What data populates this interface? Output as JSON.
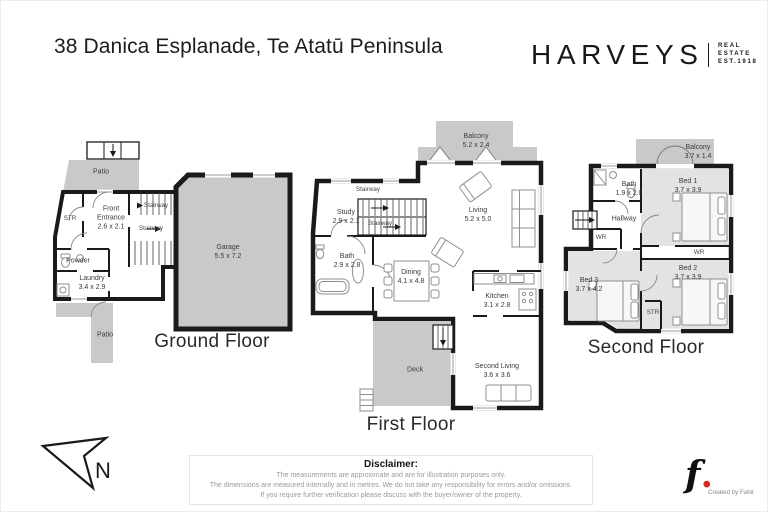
{
  "title": "38 Danica Esplanade, Te Atatū Peninsula",
  "brand": {
    "name": "HARVEYS",
    "tagline": [
      "REAL",
      "ESTATE",
      "EST.1918"
    ]
  },
  "colors": {
    "wall": "#1a1a1a",
    "outdoor_area": "#c9c9c9",
    "carpet": "#e3e3e3",
    "accent_red": "#d42b1e"
  },
  "floors": {
    "ground": {
      "name": "Ground Floor",
      "rooms": {
        "patio_top": {
          "label": "Patio"
        },
        "str": {
          "label": "STR"
        },
        "front_entrance": {
          "label": "Front Entrance",
          "dims": "2.6 x 2.1"
        },
        "stairway_upper": {
          "label": "Stairway"
        },
        "stairway_lower": {
          "label": "Stairway"
        },
        "powder": {
          "label": "Powder"
        },
        "laundry": {
          "label": "Laundry",
          "dims": "3.4 x 2.9"
        },
        "garage": {
          "label": "Garage",
          "dims": "5.5 x 7.2"
        },
        "patio_bottom": {
          "label": "Patio"
        }
      }
    },
    "first": {
      "name": "First Floor",
      "rooms": {
        "balcony": {
          "label": "Balcony",
          "dims": "5.2 x 2.4"
        },
        "stairway_upper": {
          "label": "Stairway"
        },
        "study": {
          "label": "Study",
          "dims": "2.9 x 2.1"
        },
        "stairway_lower": {
          "label": "Stairway"
        },
        "living": {
          "label": "Living",
          "dims": "5.2 x 5.0"
        },
        "bath": {
          "label": "Bath",
          "dims": "2.9 x 2.8"
        },
        "dining": {
          "label": "Dining",
          "dims": "4.1 x 4.8"
        },
        "kitchen": {
          "label": "Kitchen",
          "dims": "3.1 x 2.8"
        },
        "deck": {
          "label": "Deck"
        },
        "second_living": {
          "label": "Second Living",
          "dims": "3.6 x 3.6"
        }
      }
    },
    "second": {
      "name": "Second Floor",
      "rooms": {
        "balcony": {
          "label": "Balcony",
          "dims": "3.7 x 1.4"
        },
        "bath": {
          "label": "Bath",
          "dims": "1.9 x 2.0"
        },
        "bed1": {
          "label": "Bed 1",
          "dims": "3.7 x 3.9"
        },
        "hallway": {
          "label": "Hallway"
        },
        "wr_left": {
          "label": "WR"
        },
        "wr_right": {
          "label": "WR"
        },
        "bed3": {
          "label": "Bed 3",
          "dims": "3.7 x 4.2"
        },
        "bed2": {
          "label": "Bed 2",
          "dims": "3.7 x 3.9"
        },
        "str": {
          "label": "STR"
        }
      }
    }
  },
  "compass": {
    "letter": "N"
  },
  "disclaimer": {
    "heading": "Disclaimer:",
    "lines": [
      "The measurements are approximate and are for illustration purposes only.",
      "The dimensions are measured internally and in metres. We do not take any responsibility for errors and/or omissions.",
      "If you require further verification please discuss with the buyer/owner of the property."
    ]
  },
  "credit": {
    "logo_letter": "f",
    "logo_dot": ".",
    "text": "Created by Fabit"
  }
}
